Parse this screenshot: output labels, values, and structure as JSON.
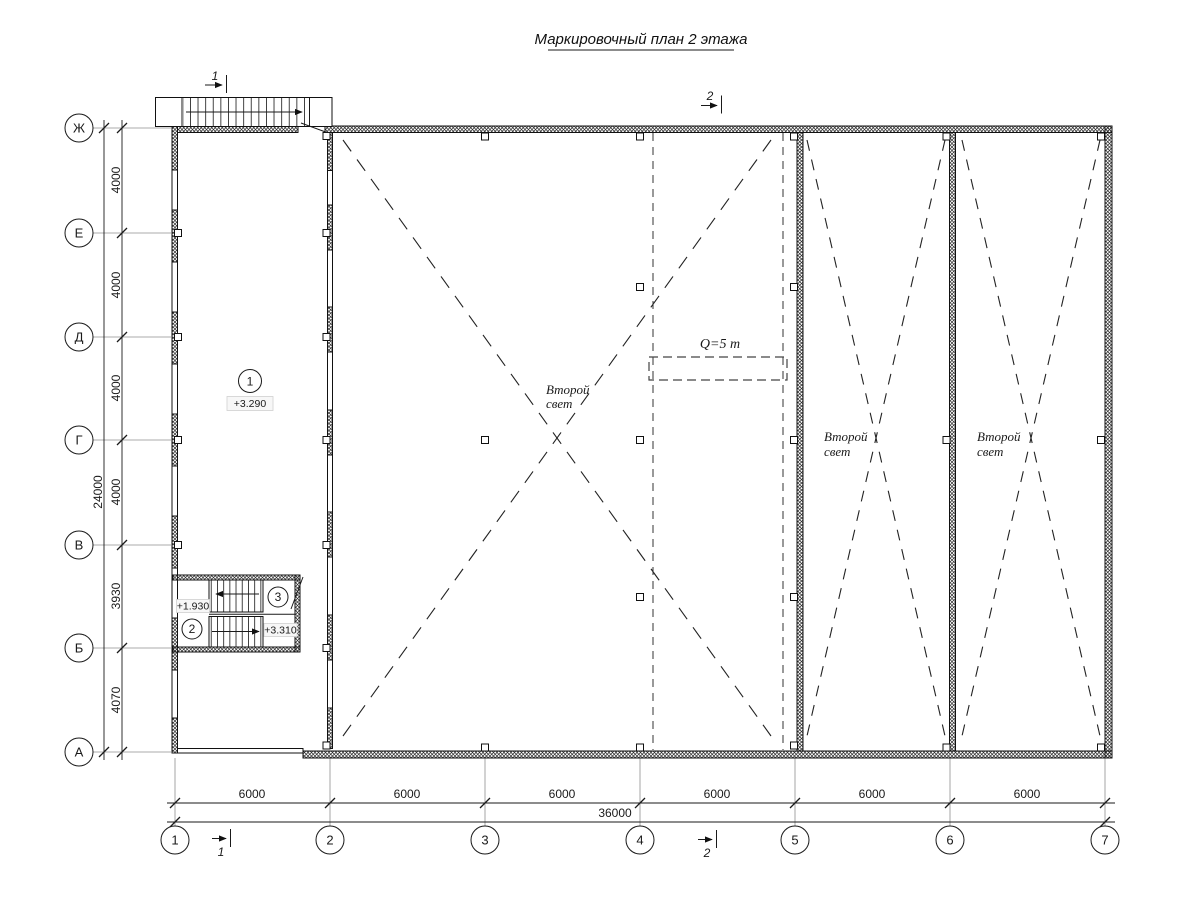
{
  "title": "Маркировочный план 2 этажа",
  "axes": {
    "rows": [
      "Ж",
      "Е",
      "Д",
      "Г",
      "В",
      "Б",
      "А"
    ],
    "cols": [
      "1",
      "2",
      "3",
      "4",
      "5",
      "6",
      "7"
    ]
  },
  "dims": {
    "left": [
      "4000",
      "4000",
      "4000",
      "4000",
      "3930",
      "4070"
    ],
    "left_total": "24000",
    "bottom": [
      "6000",
      "6000",
      "6000",
      "6000",
      "6000",
      "6000"
    ],
    "bottom_total": "36000"
  },
  "sections": {
    "one": "1",
    "two": "2"
  },
  "marks": {
    "hall": {
      "num": "1",
      "elevation": "+3.290"
    },
    "stair_lower": {
      "num": "2",
      "elevation": "+1.930"
    },
    "stair_upper": {
      "num": "3",
      "elevation": "+3.310"
    }
  },
  "labels": {
    "crane_capacity": "Q=5 т",
    "second_light": {
      "line1": "Второй",
      "line2": "свет"
    }
  },
  "colors": {
    "line": "#1a1a1a",
    "axis_line": "#8f8f8f"
  }
}
